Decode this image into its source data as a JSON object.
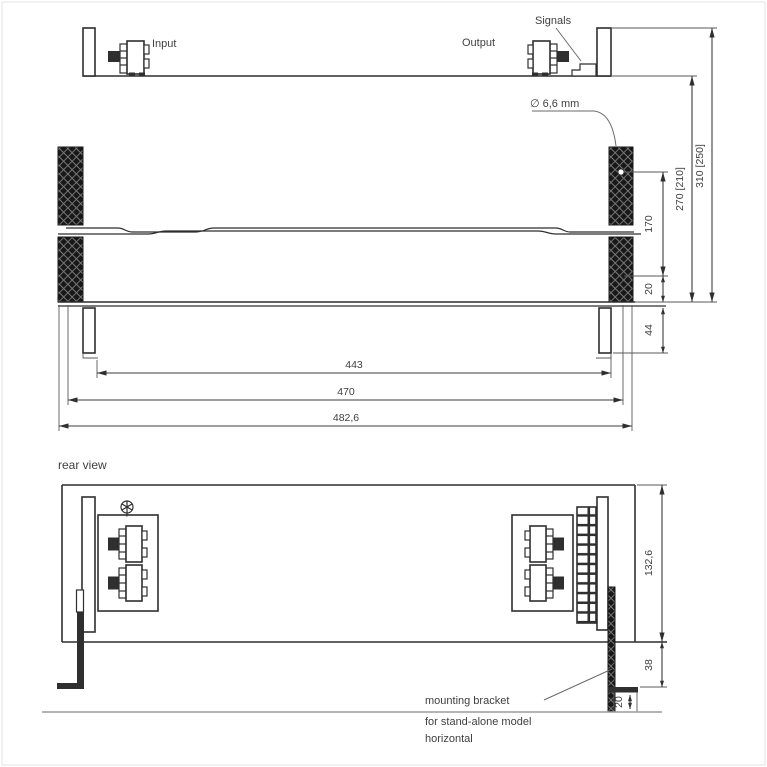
{
  "top_view": {
    "labels": {
      "input": "Input",
      "output": "Output",
      "signals": "Signals",
      "mounting_hole": "∅ 6,6 mm"
    },
    "dimensions": {
      "hole_pitch": "170",
      "base_offset": "20",
      "rail_height": "44",
      "depth_body": "270 [210]",
      "depth_overall": "310 [250]",
      "width_inner": "443",
      "width_mid": "470",
      "width_overall": "482,6"
    }
  },
  "rear_view": {
    "title": "rear view",
    "dimensions": {
      "height": "132,6",
      "bracket_drop": "38",
      "foot_height": "20"
    },
    "note": {
      "line1": "mounting bracket",
      "line2": "for stand-alone model",
      "line3": "horizontal"
    }
  },
  "colors": {
    "ink": "#2f2f2f",
    "dim_line": "#3d3d3d",
    "text": "#3f3f3f",
    "hatch_dark": "#181818",
    "ground_line": "#9b9b9b",
    "background": "#ffffff"
  }
}
